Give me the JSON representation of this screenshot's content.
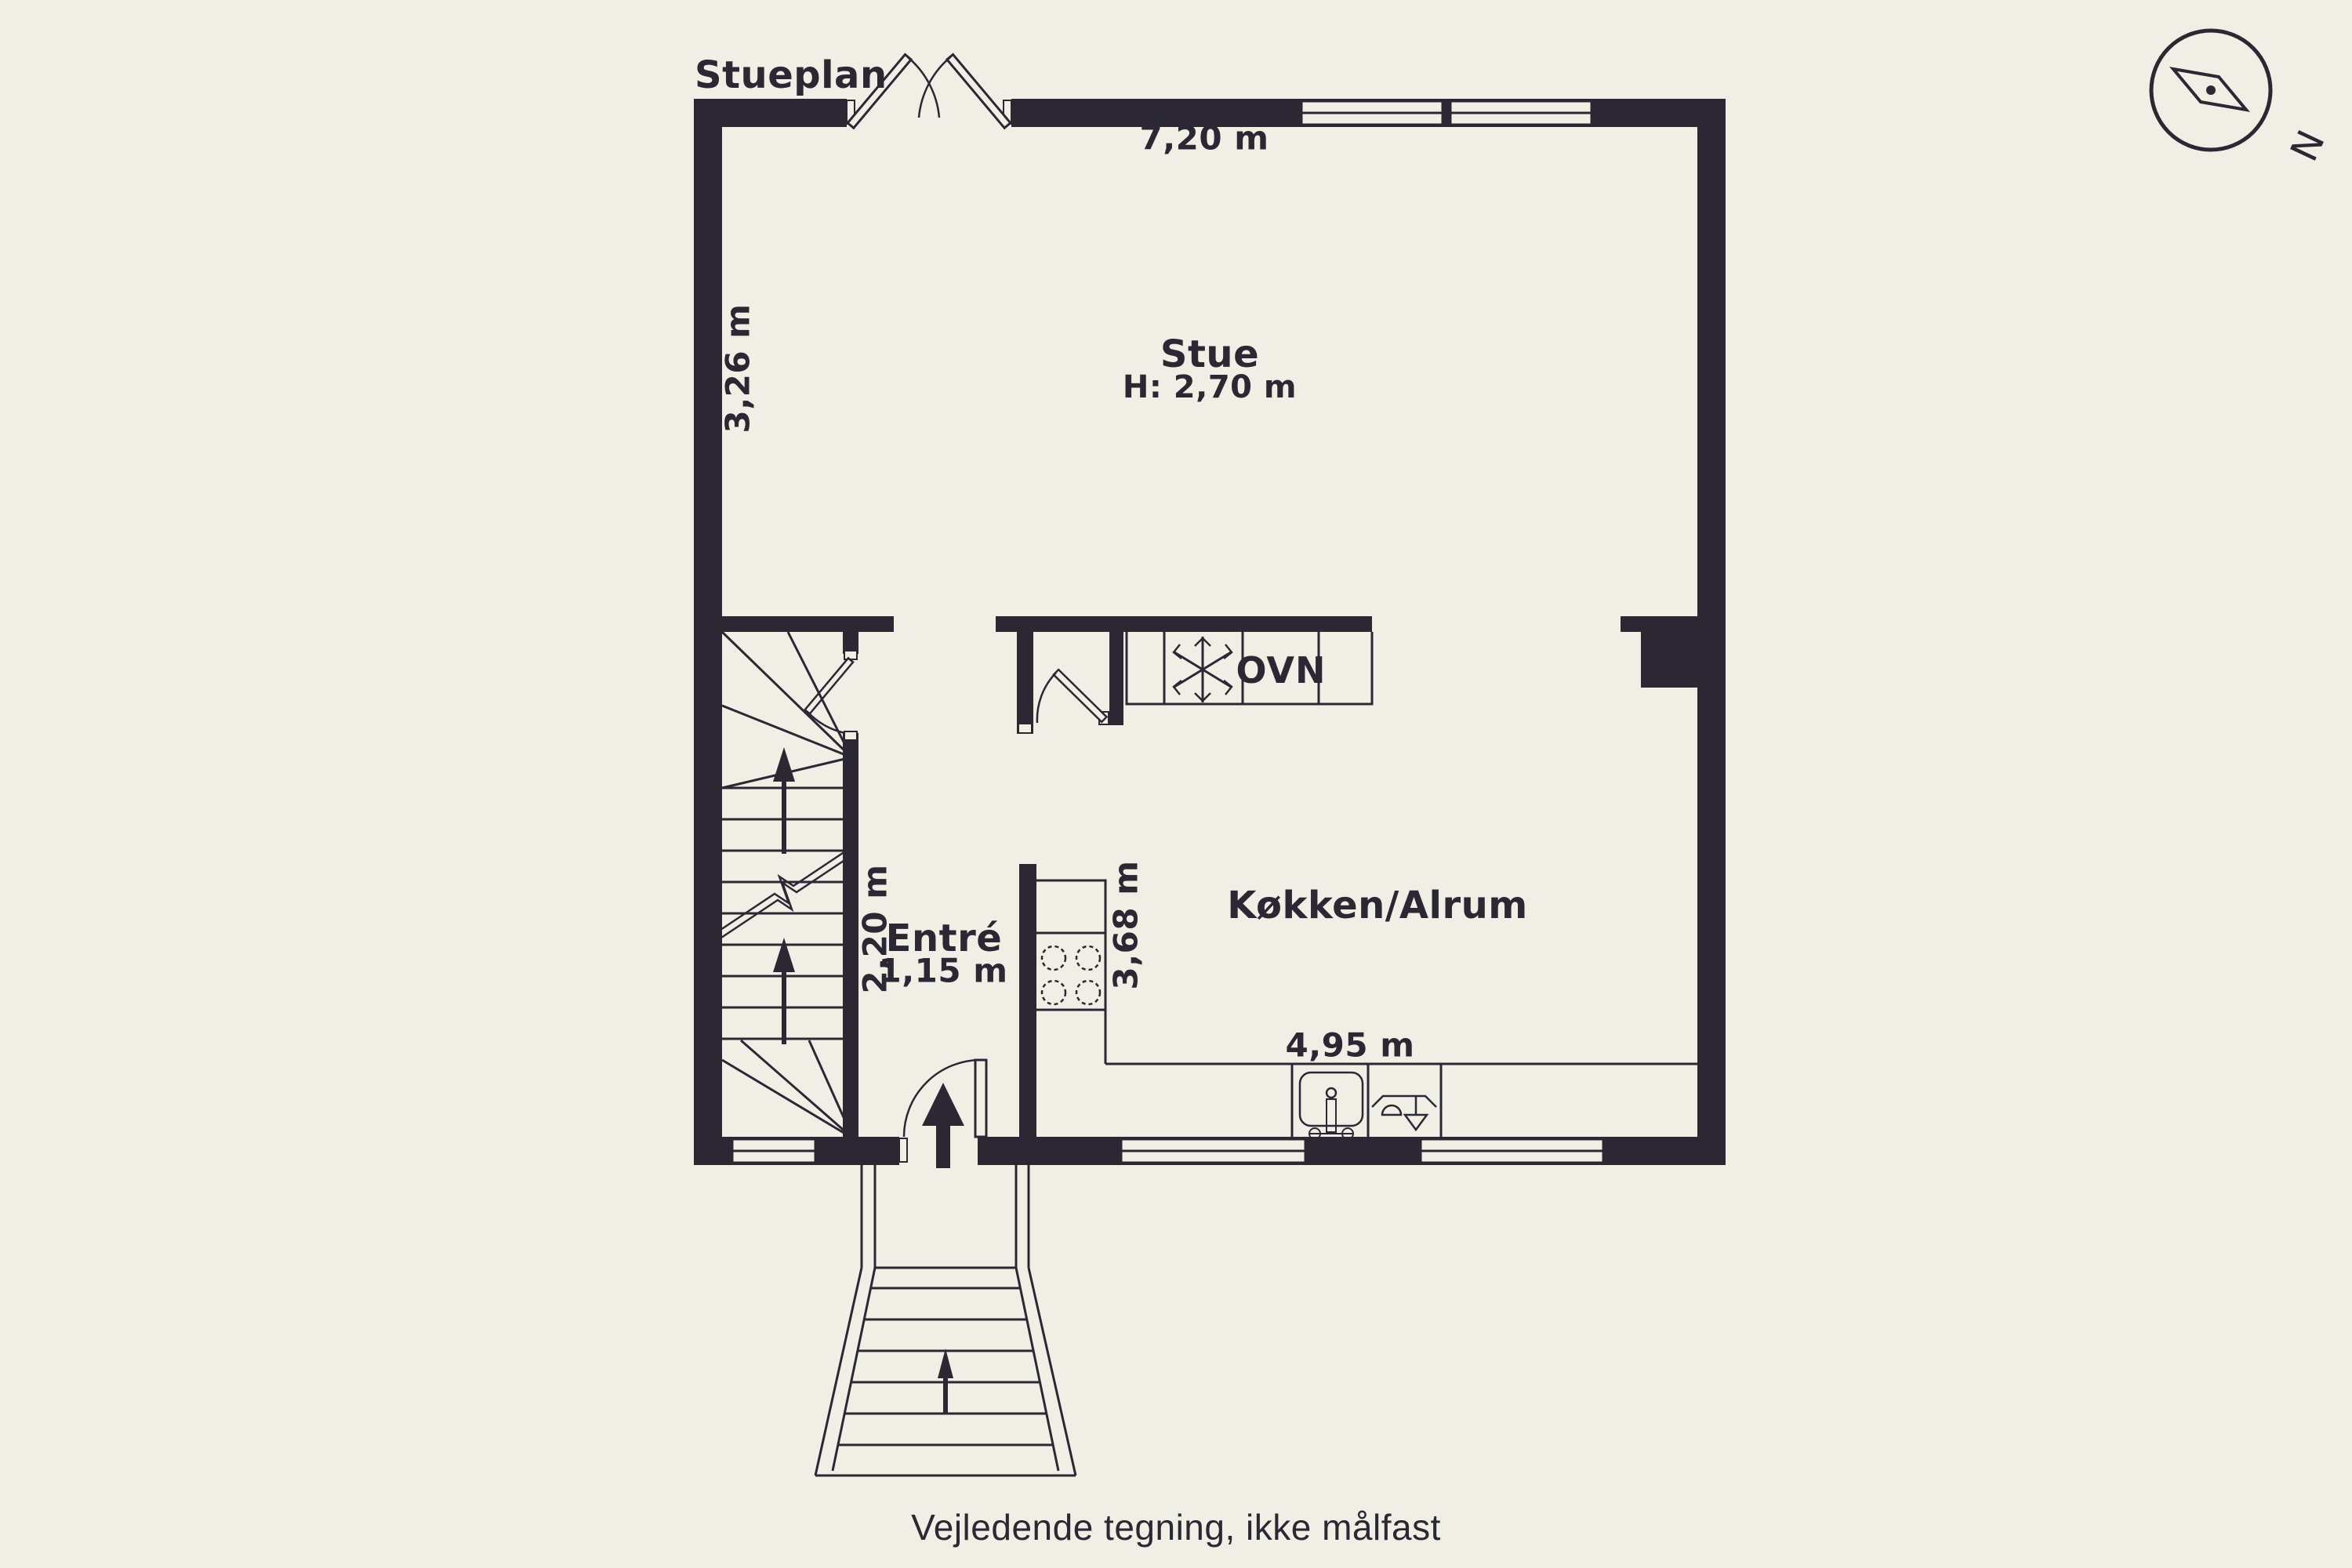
{
  "title": "Stueplan",
  "footer": {
    "note": "Vejledende tegning, ikke målfast"
  },
  "compass": {
    "north_label": "N"
  },
  "rooms": {
    "stue": {
      "name": "Stue",
      "height_note": "H: 2,70 m"
    },
    "entre": {
      "name": "Entré",
      "width_note": "1,15 m"
    },
    "kitchen": {
      "name": "Køkken/Alrum"
    }
  },
  "appliances": {
    "oven_label": "OVN",
    "freezer_icon": "snowflake-icon"
  },
  "dimensions": {
    "stue_width": "7,20 m",
    "stue_left_height": "3,26 m",
    "stair_depth": "2,20 m",
    "kitchen_left_depth": "3,68 m",
    "kitchen_width": "4,95 m"
  },
  "colors": {
    "background": "#f0efe6",
    "wall": "#2b2833"
  }
}
